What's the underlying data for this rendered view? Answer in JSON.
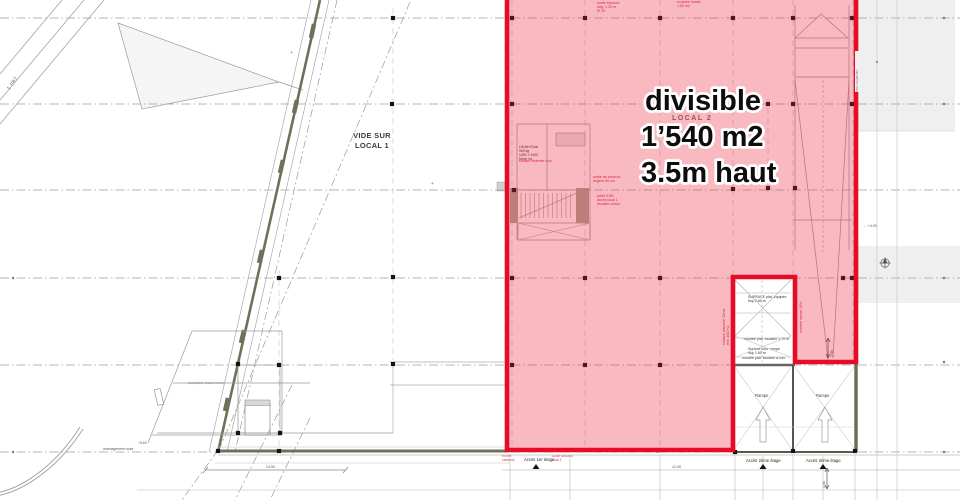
{
  "highlight": {
    "line1": "divisible",
    "line2": "1’540 m2",
    "line3": "3.5m haut",
    "fill": "rgba(232,22,48,0.30)",
    "border": "#e60c26"
  },
  "labels": {
    "vide_sur_local": "VIDE SUR\nLOCAL 1",
    "local2": "LOCAL 2",
    "brut": "brut",
    "rampe_left": "Rampe",
    "rampe_right": "Rampe",
    "acces_1er": "Accès 1er étage",
    "acces_2eme_left": "Accès 2ème étage",
    "acces_2eme_right": "Accès 2ème étage",
    "elevation_mark": "1 087"
  },
  "annotations": {
    "stair_note": "Lift-Bel Rock\n900 kg\n1400 × 2400\nMont. int.",
    "stair_note_red": "surface réservée tech.",
    "gaine_box": "Gaine\ntechn.",
    "exit_note_red": "sortie de secours\nlargeur 90 cm",
    "door_note_red": "porte EI30\naccès local 1\nescalier comm.",
    "top_note_red": "sortie secours\nlarg. 1.20 m\nEI 30",
    "top_note_red2": "exutoire fumée\n1.50 m2",
    "hsp_note_red": "hsp 3.50 m",
    "notch_note1": "SURFACE plat. équipée\nhsp 2.60 m",
    "notch_note2": "montée plat. escalier 1.70 m",
    "notch_note3": "Surface pour rampe\nhsp 2.60 m",
    "notch_note4": "montée plat. escalier à voir",
    "side_note_red": "surface plancher 2ème\nenv. 160 m2",
    "ramp_note_red": "montée rampe 15%",
    "firewall_note": "mur coupe-feu",
    "dim_v1": "2.50",
    "dim_v2": "4.90",
    "level_note": "→ +4.00",
    "room_note": "séparation locaux béton",
    "route_note": "aménagement route",
    "level_note2": "+5.60",
    "dim_h1": "14.50",
    "dim_h2": "12.00",
    "plus1": "+",
    "plus2": "+",
    "plus3": "+",
    "acces1_red_left": "entrée\ncamions",
    "acces1_red_right": "sortie secours\nlocal 1"
  },
  "colors": {
    "wall_olive": "#70705a",
    "grey_fill": "#efefef",
    "marker": "#141414",
    "grid": "#9e9e9e"
  }
}
